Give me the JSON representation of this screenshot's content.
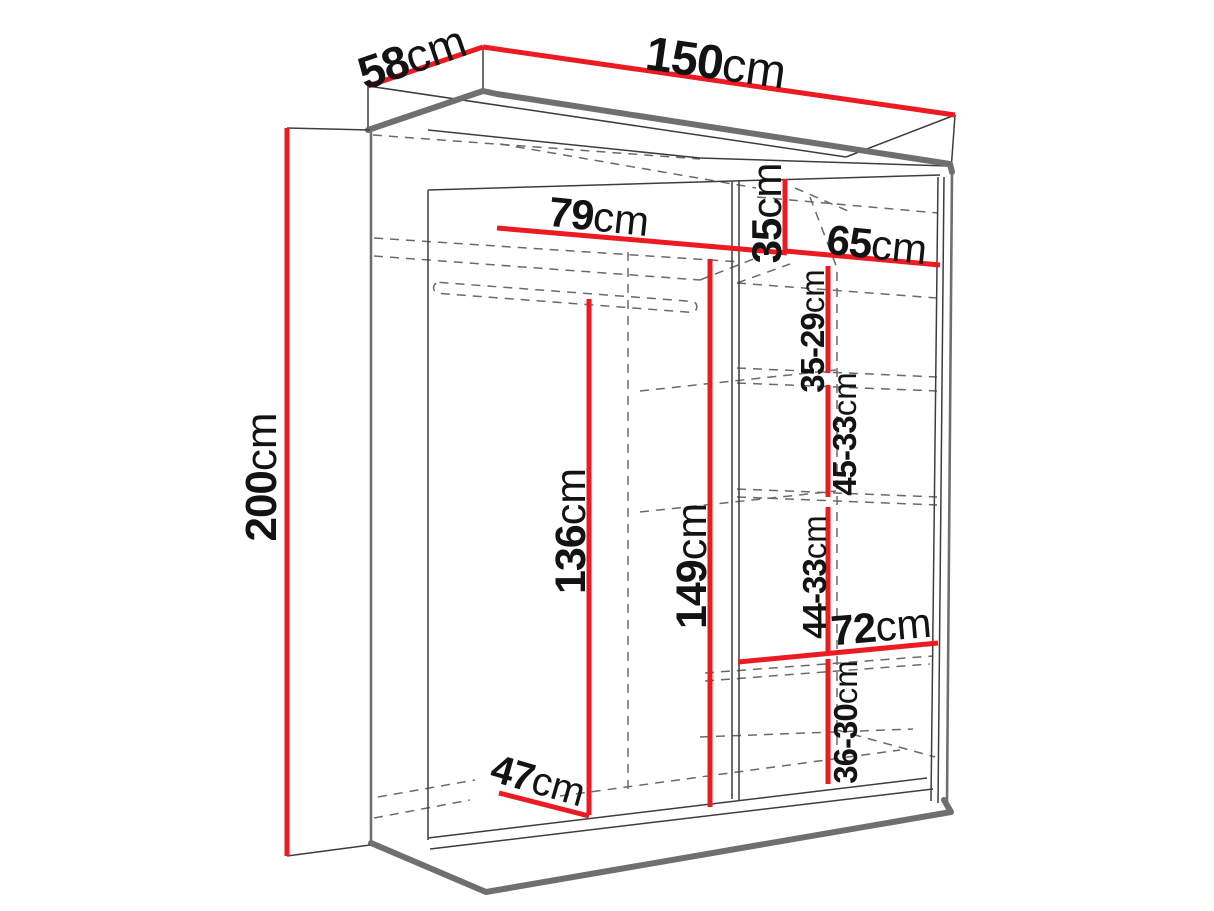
{
  "title": "Wardrobe dimension diagram",
  "colors": {
    "red": "#ec1b21",
    "outline": "#6f6f6f",
    "line": "#3d3d3d",
    "dashed": "#6a6a6a",
    "text": "#131313",
    "background": "#ffffff"
  },
  "labels": {
    "depth": {
      "value": "58",
      "unit": "cm"
    },
    "width": {
      "value": "150",
      "unit": "cm"
    },
    "height": {
      "value": "200",
      "unit": "cm"
    },
    "left_width": {
      "value": "79",
      "unit": "cm"
    },
    "top_shelf": {
      "value": "35",
      "unit": "cm"
    },
    "right_width": {
      "value": "65",
      "unit": "cm"
    },
    "gap1": {
      "value": "35-29",
      "unit": "cm"
    },
    "gap2": {
      "value": "45-33",
      "unit": "cm"
    },
    "rail_height": {
      "value": "136",
      "unit": "cm"
    },
    "interior_height": {
      "value": "149",
      "unit": "cm"
    },
    "gap3": {
      "value": "44-33",
      "unit": "cm"
    },
    "shelf_width": {
      "value": "72",
      "unit": "cm"
    },
    "gap4": {
      "value": "36-30",
      "unit": "cm"
    },
    "bottom_depth": {
      "value": "47",
      "unit": "cm"
    }
  }
}
